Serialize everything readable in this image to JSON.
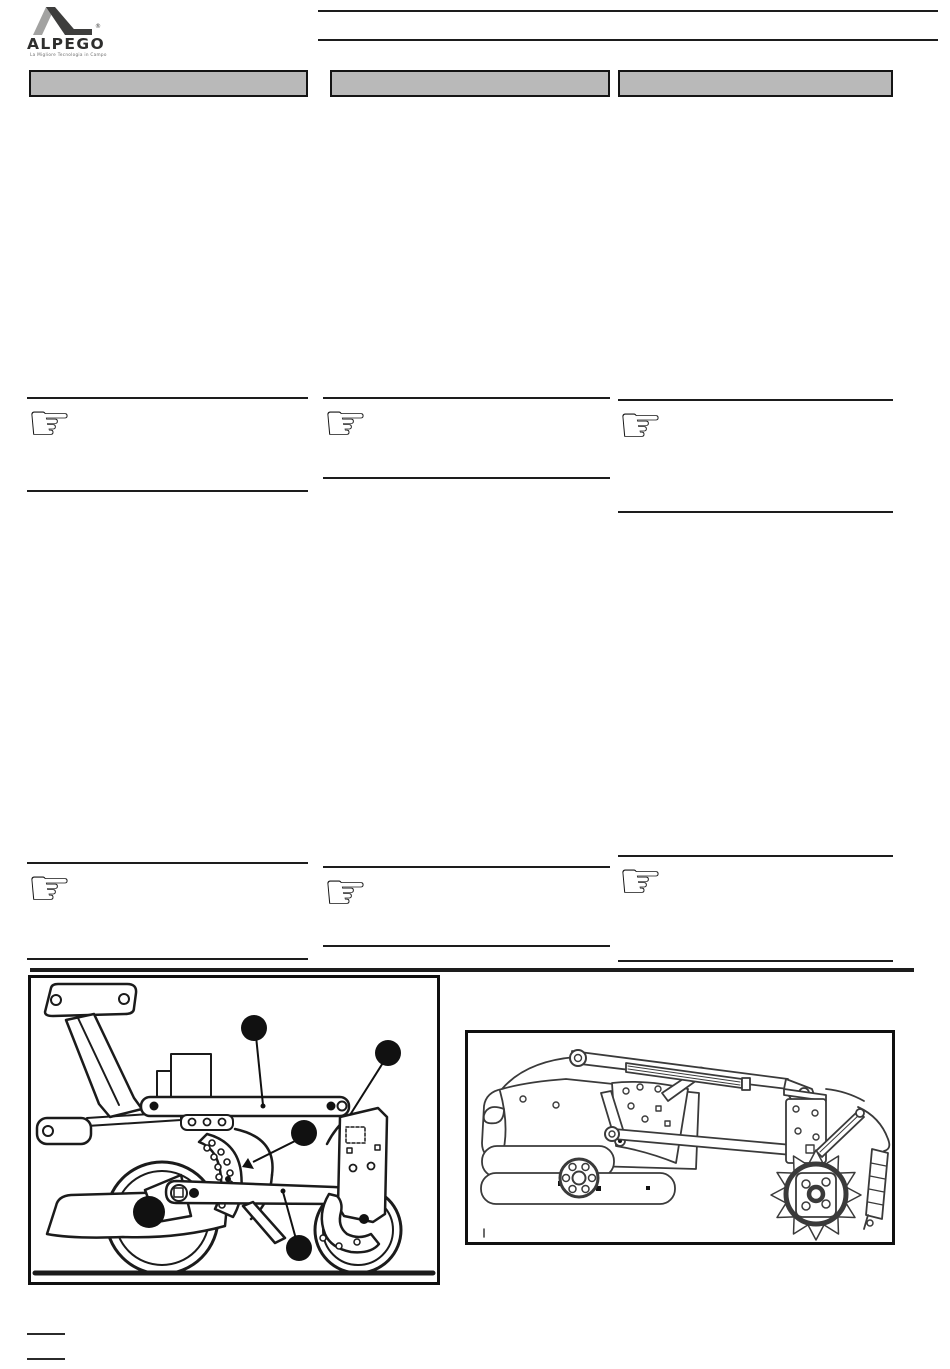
{
  "brand": {
    "name": "ALPEGO",
    "registered": "®",
    "tagline": "La Migliore Tecnologia in Campo"
  },
  "icons": {
    "pointing_hand": "☞"
  },
  "sections": {
    "bars": [
      {
        "label": ""
      },
      {
        "label": ""
      },
      {
        "label": ""
      }
    ]
  },
  "notes": [
    {
      "id": "note-left-1",
      "text": ""
    },
    {
      "id": "note-center-1",
      "text": ""
    },
    {
      "id": "note-right-1",
      "text": ""
    },
    {
      "id": "note-left-2",
      "text": ""
    },
    {
      "id": "note-center-2",
      "text": ""
    },
    {
      "id": "note-right-2",
      "text": ""
    }
  ],
  "figures": {
    "left": {
      "callout_count": 5
    },
    "right": {
      "callout_count": 0
    }
  },
  "colors": {
    "bar_fill": "#b9b9b9",
    "line": "#1d1d1d",
    "logo_light": "#a2a2a1",
    "logo_dark": "#3d3d3c"
  }
}
